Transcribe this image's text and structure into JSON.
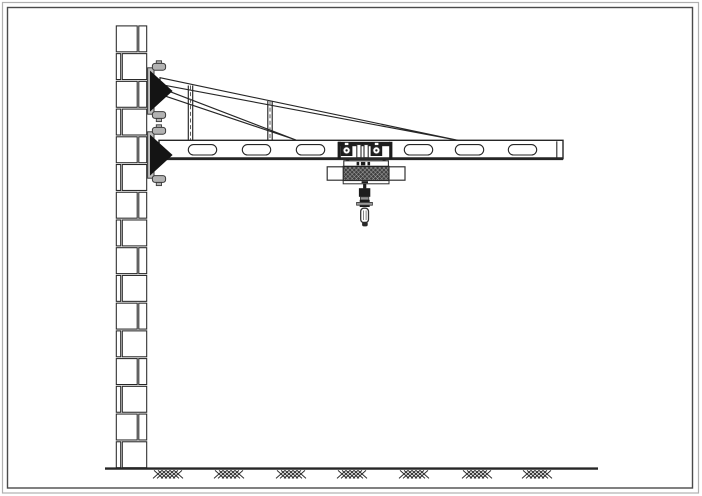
{
  "drawing": {
    "description": "side-elevation-of-wall-mounted-jib-crane-with-hoist-trolley",
    "canvas": {
      "width": 702,
      "height": 496
    },
    "colors": {
      "paper": "#ffffff",
      "line": "#262626",
      "line_soft": "#4a4a4a",
      "solid_fill": "#161616",
      "steel_gray": "#b3b3b3",
      "frame_outer": "#b0b0b0",
      "frame_inner": "#4a4a4a",
      "hoist_texture_base": "#404040",
      "hoist_texture_line": "#c8c8c8"
    },
    "frame": {
      "parts": [
        {
          "t": "rect",
          "name": "outer-border",
          "x": 2.5,
          "y": 2.5,
          "w": 696,
          "h": 490.5,
          "fill": "none",
          "stroke": "#b0b0b0",
          "sw": 1.2
        },
        {
          "t": "rect",
          "name": "inner-border",
          "x": 7.5,
          "y": 7.5,
          "w": 685,
          "h": 480.5,
          "fill": "none",
          "stroke": "#4a4a4a",
          "sw": 1.4
        }
      ]
    },
    "wall": {
      "left": 115.5,
      "width": 32,
      "top": 25,
      "bottom": 468.6,
      "row_count": 16,
      "joint_offset_right": 22.5,
      "joint_offset_left": 6,
      "brick_inset_x": 0.8,
      "brick_inset_y": 0.9,
      "stroke": "#262626",
      "sw": 1.05,
      "fill": "#ffffff"
    },
    "ground": {
      "y": 468.6,
      "x1": 105,
      "x2": 598,
      "line_width": 2.4,
      "stroke": "#262626",
      "hatch": {
        "centers": [
          168,
          229,
          291,
          352,
          414,
          477,
          537
        ],
        "stroke_len": 9,
        "top": 470.4,
        "rise": 8,
        "slash_offsets": [
          -15,
          -11,
          -7,
          -3,
          1,
          5
        ],
        "backslash_offsets": [
          -14,
          -10,
          -6,
          -2,
          2,
          6
        ],
        "stroke": "#2a2a2a",
        "sw": 0.95
      }
    },
    "truss": {
      "stroke": "#262626",
      "sw": 1.15,
      "fill": "#ffffff",
      "upper_rod": {
        "x1": 160,
        "y_top1": 77.7,
        "y_bot1": 84.4,
        "x2": 458,
        "y2": 140.3
      },
      "lower_rod": {
        "x1": 160,
        "y_top1": 87.8,
        "y_bot1": 94.3,
        "x2": 296,
        "y2": 140
      },
      "struts": [
        {
          "x_left": 188.3,
          "x_right": 192.7,
          "center": 190.5,
          "top": 85.5,
          "bottom": 140.5
        },
        {
          "x_left": 267.8,
          "x_right": 272.2,
          "center": 270,
          "top": 101,
          "bottom": 140.5
        }
      ],
      "strut_dash": "4 2.6",
      "strut_dash_color": "#4a4a4a",
      "strut_dash_sw": 0.9
    },
    "beam": {
      "x": 159,
      "y": 140.3,
      "w": 404,
      "h": 18.4,
      "stroke": "#262626",
      "sw": 1.4,
      "fill": "#ffffff",
      "bottom_y": 158.7,
      "bottom_sw": 2.8,
      "end_cap_x": 556.8,
      "slots": {
        "centers": [
          202.5,
          256.5,
          310.5,
          364.5,
          418.5,
          469.5,
          522.5
        ],
        "hidden_index": 3,
        "width": 28.4,
        "height": 10.4,
        "top": 144.6,
        "rx": 5.2,
        "sw": 1.1
      }
    },
    "brackets": [
      {
        "id": "upper-wall-bracket",
        "parts": [
          {
            "t": "rect",
            "name": "back-plate",
            "x": 147.6,
            "y": 67.8,
            "w": 6.4,
            "h": 46.4,
            "fill": "#bdbdbd",
            "stroke": "#3a3a3a",
            "sw": 1
          },
          {
            "t": "rect",
            "name": "anchor-stem-top",
            "x": 156.3,
            "y": 60.8,
            "w": 5.2,
            "h": 3.4,
            "fill": "#b3b3b3",
            "stroke": "#3a3a3a",
            "sw": 0.9
          },
          {
            "t": "rect",
            "name": "anchor-bolt-top",
            "x": 152.4,
            "y": 63.4,
            "w": 13.2,
            "h": 6.8,
            "rx": 2.6,
            "fill": "#b3b3b3",
            "stroke": "#3a3a3a",
            "sw": 1
          },
          {
            "t": "rect",
            "name": "anchor-stem-bottom",
            "x": 156.3,
            "y": 118.2,
            "w": 5.2,
            "h": 3.4,
            "fill": "#b3b3b3",
            "stroke": "#3a3a3a",
            "sw": 0.9
          },
          {
            "t": "rect",
            "name": "anchor-bolt-bottom",
            "x": 152.4,
            "y": 111.6,
            "w": 13.2,
            "h": 6.8,
            "rx": 2.6,
            "fill": "#b3b3b3",
            "stroke": "#3a3a3a",
            "sw": 1
          },
          {
            "t": "poly",
            "name": "gusset-wedge",
            "points": [
              [
                150,
                70.6
              ],
              [
                150,
                111.6
              ],
              [
                172.6,
                91
              ]
            ],
            "fill": "#141414",
            "stroke": "none",
            "sw": 0
          }
        ]
      },
      {
        "id": "lower-wall-bracket",
        "parts": [
          {
            "t": "rect",
            "name": "back-plate",
            "x": 147.6,
            "y": 131.8,
            "w": 6.4,
            "h": 46.4,
            "fill": "#bdbdbd",
            "stroke": "#3a3a3a",
            "sw": 1
          },
          {
            "t": "rect",
            "name": "anchor-stem-top",
            "x": 156.3,
            "y": 124.8,
            "w": 5.2,
            "h": 3.4,
            "fill": "#b3b3b3",
            "stroke": "#3a3a3a",
            "sw": 0.9
          },
          {
            "t": "rect",
            "name": "anchor-bolt-top",
            "x": 152.4,
            "y": 127.4,
            "w": 13.2,
            "h": 6.8,
            "rx": 2.6,
            "fill": "#b3b3b3",
            "stroke": "#3a3a3a",
            "sw": 1
          },
          {
            "t": "rect",
            "name": "anchor-stem-bottom",
            "x": 156.3,
            "y": 182.2,
            "w": 5.2,
            "h": 3.4,
            "fill": "#b3b3b3",
            "stroke": "#3a3a3a",
            "sw": 0.9
          },
          {
            "t": "rect",
            "name": "anchor-bolt-bottom",
            "x": 152.4,
            "y": 175.6,
            "w": 13.2,
            "h": 6.8,
            "rx": 2.6,
            "fill": "#b3b3b3",
            "stroke": "#3a3a3a",
            "sw": 1
          },
          {
            "t": "poly",
            "name": "gusset-wedge",
            "points": [
              [
                150,
                134.6
              ],
              [
                150,
                175.6
              ],
              [
                172.6,
                155
              ]
            ],
            "fill": "#141414",
            "stroke": "none",
            "sw": 0
          }
        ]
      }
    ],
    "hoist": {
      "parts": [
        {
          "t": "rect",
          "name": "slot-mask",
          "x": 352,
          "y": 143,
          "w": 18,
          "h": 14,
          "fill": "#ffffff",
          "stroke": "none",
          "sw": 0
        },
        {
          "t": "rect",
          "name": "trolley-bar",
          "x": 338,
          "y": 141.8,
          "w": 52,
          "h": 4.4,
          "fill": "#1c1c1c",
          "stroke": "none",
          "sw": 0
        },
        {
          "t": "rect",
          "name": "trolley-bar-notch-left",
          "x": 344.8,
          "y": 142.8,
          "w": 3.6,
          "h": 2.4,
          "fill": "#ffffff",
          "stroke": "none",
          "sw": 0
        },
        {
          "t": "rect",
          "name": "trolley-bar-notch-right",
          "x": 374.8,
          "y": 142.8,
          "w": 3.6,
          "h": 2.4,
          "fill": "#ffffff",
          "stroke": "none",
          "sw": 0
        },
        {
          "t": "rect",
          "name": "trolley-plate-left",
          "x": 337.6,
          "y": 141.8,
          "w": 3.2,
          "h": 17.2,
          "fill": "#1c1c1c",
          "stroke": "none",
          "sw": 0
        },
        {
          "t": "rect",
          "name": "trolley-plate-right",
          "x": 389.2,
          "y": 141.8,
          "w": 3.2,
          "h": 17.2,
          "fill": "#1c1c1c",
          "stroke": "none",
          "sw": 0
        },
        {
          "t": "rect",
          "name": "wheel-block-left",
          "x": 340.8,
          "y": 145.2,
          "w": 11.6,
          "h": 10.8,
          "fill": "#1c1c1c",
          "stroke": "none",
          "sw": 0
        },
        {
          "t": "rect",
          "name": "wheel-block-right",
          "x": 370.6,
          "y": 145.2,
          "w": 11.6,
          "h": 10.8,
          "fill": "#1c1c1c",
          "stroke": "none",
          "sw": 0
        },
        {
          "t": "circle",
          "name": "trolley-wheel-left",
          "cx": 346.6,
          "cy": 150.4,
          "r": 3.6,
          "fill": "#ffffff",
          "stroke": "#333333",
          "sw": 1
        },
        {
          "t": "circle",
          "name": "trolley-wheel-right",
          "cx": 376.4,
          "cy": 150.4,
          "r": 3.6,
          "fill": "#ffffff",
          "stroke": "#333333",
          "sw": 1
        },
        {
          "t": "circle",
          "name": "wheel-hub-left",
          "cx": 346.6,
          "cy": 150.4,
          "r": 1.2,
          "fill": "#222222",
          "stroke": "none",
          "sw": 0
        },
        {
          "t": "circle",
          "name": "wheel-hub-right",
          "cx": 376.4,
          "cy": 150.4,
          "r": 1.2,
          "fill": "#222222",
          "stroke": "none",
          "sw": 0
        },
        {
          "t": "rect",
          "name": "suspension-bar-left",
          "x": 356.8,
          "y": 144.5,
          "w": 4.2,
          "h": 13.2,
          "fill": "#ffffff",
          "stroke": "#2c2c2c",
          "sw": 1.1
        },
        {
          "t": "rect",
          "name": "suspension-bar-right",
          "x": 364,
          "y": 144.5,
          "w": 4.2,
          "h": 13.2,
          "fill": "#ffffff",
          "stroke": "#2c2c2c",
          "sw": 1.1
        },
        {
          "t": "rect",
          "name": "hoist-stud-left",
          "x": 346.2,
          "y": 159.4,
          "w": 3,
          "h": 1.6,
          "fill": "#1c1c1c",
          "stroke": "none",
          "sw": 0
        },
        {
          "t": "rect",
          "name": "hoist-stud-right",
          "x": 382.6,
          "y": 159.4,
          "w": 3,
          "h": 1.6,
          "fill": "#1c1c1c",
          "stroke": "none",
          "sw": 0
        },
        {
          "t": "rect",
          "name": "hoist-top-plate",
          "x": 343.8,
          "y": 160.8,
          "w": 44.6,
          "h": 5.6,
          "fill": "#ffffff",
          "stroke": "#2c2c2c",
          "sw": 1.1
        },
        {
          "t": "rect",
          "name": "top-plate-tick-1",
          "x": 356.6,
          "y": 161.9,
          "w": 2.6,
          "h": 3.4,
          "fill": "#1c1c1c",
          "stroke": "none",
          "sw": 0
        },
        {
          "t": "rect",
          "name": "top-plate-tick-2",
          "x": 360.9,
          "y": 161.9,
          "w": 4.4,
          "h": 3.4,
          "fill": "#1c1c1c",
          "stroke": "none",
          "sw": 0
        },
        {
          "t": "rect",
          "name": "top-plate-tick-3",
          "x": 367.5,
          "y": 161.9,
          "w": 2.6,
          "h": 3.4,
          "fill": "#1c1c1c",
          "stroke": "none",
          "sw": 0
        },
        {
          "t": "rect",
          "name": "motor-body",
          "x": 343.2,
          "y": 166.4,
          "w": 45.8,
          "h": 14.2,
          "fill": "@knurl",
          "stroke": "#222222",
          "sw": 1.2
        },
        {
          "t": "rect",
          "name": "end-flange-left",
          "x": 327.2,
          "y": 166.8,
          "w": 16,
          "h": 13.4,
          "fill": "#ffffff",
          "stroke": "#333333",
          "sw": 1.2
        },
        {
          "t": "rect",
          "name": "end-flange-right",
          "x": 389,
          "y": 166.8,
          "w": 16,
          "h": 13.4,
          "fill": "#ffffff",
          "stroke": "#333333",
          "sw": 1.2
        },
        {
          "t": "rect",
          "name": "hoist-bottom-band",
          "x": 343.2,
          "y": 180.6,
          "w": 45.8,
          "h": 3.2,
          "fill": "#ffffff",
          "stroke": "#2c2c2c",
          "sw": 1
        },
        {
          "t": "rect",
          "name": "bottom-band-tick",
          "x": 361.6,
          "y": 181.2,
          "w": 6.4,
          "h": 2,
          "fill": "#1c1c1c",
          "stroke": "none",
          "sw": 0
        },
        {
          "t": "rect",
          "name": "hoist-rope",
          "x": 363.1,
          "y": 183.8,
          "w": 3.2,
          "h": 4.6,
          "fill": "#1c1c1c",
          "stroke": "none",
          "sw": 0
        },
        {
          "t": "rect",
          "name": "hook-block-upper",
          "x": 358.9,
          "y": 188.2,
          "w": 11.4,
          "h": 8.6,
          "fill": "#1c1c1c",
          "stroke": "none",
          "sw": 0
        },
        {
          "t": "rect",
          "name": "hook-block-mid",
          "x": 360.4,
          "y": 196.8,
          "w": 8.4,
          "h": 3.2,
          "fill": "#8f8f8f",
          "stroke": "#333333",
          "sw": 0.8
        },
        {
          "t": "rect",
          "name": "hook-block-lower",
          "x": 359.7,
          "y": 199.8,
          "w": 10,
          "h": 7.2,
          "fill": "#1c1c1c",
          "stroke": "none",
          "sw": 0
        },
        {
          "t": "rect",
          "name": "hook-pin",
          "x": 356.6,
          "y": 202.4,
          "w": 15.8,
          "h": 2.8,
          "fill": "#9a9a9a",
          "stroke": "#333333",
          "sw": 0.8
        },
        {
          "t": "rect",
          "name": "hook-eye",
          "x": 360.7,
          "y": 208.2,
          "w": 7.8,
          "h": 14.4,
          "rx": 3.2,
          "fill": "#ffffff",
          "stroke": "#333333",
          "sw": 1.3
        },
        {
          "t": "line",
          "name": "hook-eye-line-left",
          "x1": 363.4,
          "y1": 210.5,
          "x2": 363.4,
          "y2": 220,
          "stroke": "#666666",
          "sw": 0.8
        },
        {
          "t": "line",
          "name": "hook-eye-line-right",
          "x1": 366.1,
          "y1": 210.5,
          "x2": 366.1,
          "y2": 220,
          "stroke": "#666666",
          "sw": 0.8
        },
        {
          "t": "rect",
          "name": "hook-tip",
          "x": 362.1,
          "y": 221.8,
          "w": 5.6,
          "h": 4.6,
          "rx": 1.8,
          "fill": "#2a2a2a",
          "stroke": "none",
          "sw": 0
        }
      ]
    }
  }
}
